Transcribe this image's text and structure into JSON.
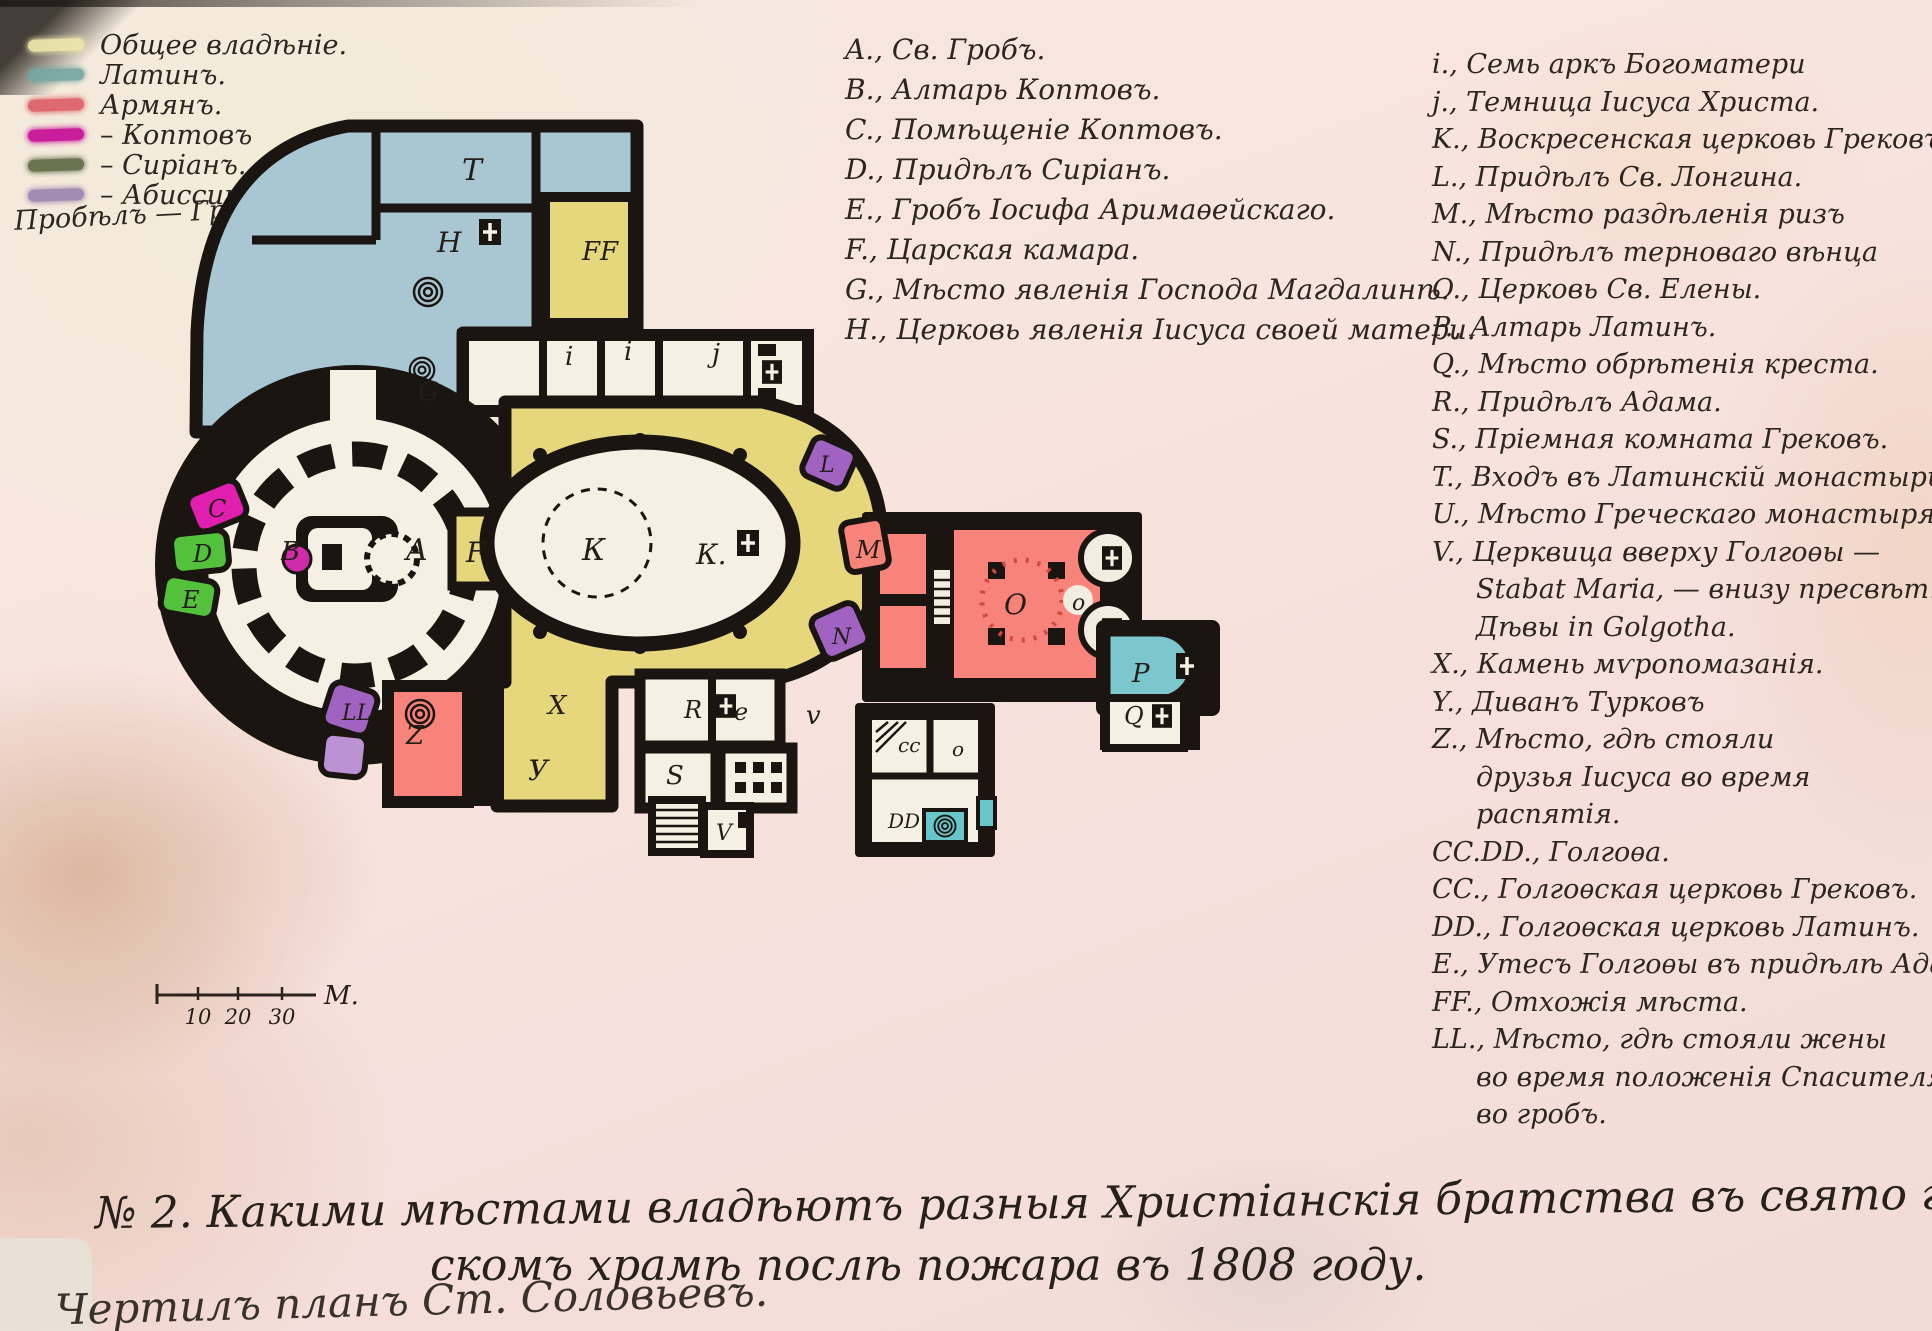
{
  "legend": {
    "items": [
      {
        "label": "Общее владѣніе.",
        "color": "#efe9ac"
      },
      {
        "label": "Латинъ.",
        "color": "#76a8a2"
      },
      {
        "label": "Армянъ.",
        "color": "#dd5f68"
      },
      {
        "label": "– Коптовъ",
        "color": "#c60d97"
      },
      {
        "label": "– Сиріанъ.",
        "color": "#5f6b44"
      },
      {
        "label": "– Абиссинцевъ",
        "color": "#9c85b0"
      }
    ],
    "footnote": "Пробѣлъ — Грековъ."
  },
  "center_list": {
    "items": [
      "A., Св. Гробъ.",
      "B., Алтарь Коптовъ.",
      "C., Помѣщеніе Коптовъ.",
      "D., Придѣлъ Сиріанъ.",
      "E., Гробъ Іосифа Аримаѳейскаго.",
      "F., Царская камара.",
      "G., Мѣсто явленія Господа Магдалинѣ.",
      "H., Церковь явленія Іисуса своей матери."
    ]
  },
  "right_list": {
    "items": [
      {
        "lines": [
          "i., Семь аркъ Богоматери"
        ]
      },
      {
        "lines": [
          "j., Темница Іисуса Христа."
        ]
      },
      {
        "lines": [
          "K., Воскресенская церковь Грековъ."
        ]
      },
      {
        "lines": [
          "L., Придѣлъ Св. Лонгина."
        ]
      },
      {
        "lines": [
          "M., Мѣсто раздѣленія ризъ"
        ]
      },
      {
        "lines": [
          "N., Придѣлъ терноваго вѣнца"
        ]
      },
      {
        "lines": [
          "O., Церковь Св. Елены."
        ]
      },
      {
        "lines": [
          "P., Алтарь Латинъ."
        ]
      },
      {
        "lines": [
          "Q., Мѣсто обрѣтенія креста."
        ]
      },
      {
        "lines": [
          "R., Придѣлъ Адама."
        ]
      },
      {
        "lines": [
          "S., Пріемная комната Грековъ."
        ]
      },
      {
        "lines": [
          "T., Входъ въ Латинскій монастырь"
        ]
      },
      {
        "lines": [
          "U., Мѣсто Греческаго монастыря"
        ]
      },
      {
        "lines": [
          "V., Церквица вверху Голгоѳы —",
          "Stabat Maria, — внизу пресвѣт.",
          "Дѣвы in Golgotha."
        ]
      },
      {
        "lines": [
          "X., Камень мѵропомазанія."
        ]
      },
      {
        "lines": [
          "Y., Диванъ Турковъ"
        ]
      },
      {
        "lines": [
          "Z., Мѣсто, гдѣ стояли",
          "друзья Іисуса во время",
          "распятія."
        ]
      },
      {
        "lines": [
          "CC.DD., Голгоѳа."
        ]
      },
      {
        "lines": [
          "CC., Голгоѳская церковь Грековъ."
        ]
      },
      {
        "lines": [
          "DD., Голгоѳская церковь Латинъ."
        ]
      },
      {
        "lines": [
          "E., Утесъ Голгоѳы въ придѣлѣ Адама."
        ]
      },
      {
        "lines": [
          "FF., Отхожія мѣста."
        ]
      },
      {
        "lines": [
          "LL., Мѣсто, гдѣ стояли жены",
          "во время положенія Спасителя",
          "во гробъ."
        ]
      }
    ]
  },
  "plan": {
    "labels": [
      {
        "t": "T",
        "x": 462,
        "y": 180,
        "s": 30
      },
      {
        "t": "H",
        "x": 437,
        "y": 252,
        "s": 28
      },
      {
        "t": "FF",
        "x": 582,
        "y": 260,
        "s": 26
      },
      {
        "t": "G",
        "x": 418,
        "y": 400,
        "s": 26
      },
      {
        "t": "i",
        "x": 565,
        "y": 365,
        "s": 26
      },
      {
        "t": "i",
        "x": 624,
        "y": 360,
        "s": 26
      },
      {
        "t": "j",
        "x": 712,
        "y": 362,
        "s": 26
      },
      {
        "t": "B",
        "x": 281,
        "y": 560,
        "s": 26
      },
      {
        "t": "A",
        "x": 406,
        "y": 560,
        "s": 30
      },
      {
        "t": "F",
        "x": 466,
        "y": 562,
        "s": 28
      },
      {
        "t": "К",
        "x": 582,
        "y": 560,
        "s": 30
      },
      {
        "t": "К.",
        "x": 696,
        "y": 564,
        "s": 28
      },
      {
        "t": "C",
        "x": 208,
        "y": 517,
        "s": 24
      },
      {
        "t": "D",
        "x": 193,
        "y": 562,
        "s": 24
      },
      {
        "t": "E",
        "x": 182,
        "y": 608,
        "s": 24
      },
      {
        "t": "LL",
        "x": 342,
        "y": 720,
        "s": 22
      },
      {
        "t": "L",
        "x": 820,
        "y": 472,
        "s": 22
      },
      {
        "t": "М",
        "x": 856,
        "y": 558,
        "s": 24
      },
      {
        "t": "N",
        "x": 832,
        "y": 644,
        "s": 22
      },
      {
        "t": "X",
        "x": 548,
        "y": 714,
        "s": 26
      },
      {
        "t": "У",
        "x": 528,
        "y": 780,
        "s": 28
      },
      {
        "t": "Z",
        "x": 406,
        "y": 744,
        "s": 26
      },
      {
        "t": "R",
        "x": 684,
        "y": 718,
        "s": 24
      },
      {
        "t": "e",
        "x": 734,
        "y": 720,
        "s": 24
      },
      {
        "t": "S",
        "x": 666,
        "y": 784,
        "s": 26
      },
      {
        "t": "V",
        "x": 716,
        "y": 840,
        "s": 22
      },
      {
        "t": "v",
        "x": 806,
        "y": 724,
        "s": 26
      },
      {
        "t": "О",
        "x": 1004,
        "y": 614,
        "s": 28
      },
      {
        "t": "o",
        "x": 1072,
        "y": 610,
        "s": 22
      },
      {
        "t": "P",
        "x": 1132,
        "y": 682,
        "s": 26
      },
      {
        "t": "Q",
        "x": 1124,
        "y": 724,
        "s": 24
      },
      {
        "t": "cc",
        "x": 898,
        "y": 752,
        "s": 20
      },
      {
        "t": "o",
        "x": 952,
        "y": 756,
        "s": 20
      },
      {
        "t": "DD",
        "x": 888,
        "y": 828,
        "s": 20
      }
    ]
  },
  "scale_bar": {
    "ticks": [
      {
        "label": "10",
        "x": 198
      },
      {
        "label": "20",
        "x": 238
      },
      {
        "label": "30",
        "x": 282
      }
    ],
    "unit": "М.",
    "unit_x": 324
  },
  "caption": {
    "line1": "№ 2. Какими мѣстами владѣютъ разныя Христіанскія братства въ свято гроб-",
    "line2": "скомъ храмѣ послѣ пожара въ 1808 году."
  },
  "signature": "Чертилъ планъ Ст. Соловьевъ.",
  "icons": {
    "altar_cross_icon": "⊞",
    "spiral_stair_icon": "◎"
  },
  "colors": {
    "common_yellow": "#e7d77c",
    "latin_blue": "#a9c6d3",
    "armenian_red": "#f8837a",
    "coptic_magenta": "#e01fae",
    "syrian_green": "#53c13c",
    "abyssinian_purple": "#a163c2",
    "teal_rooms": "#68c6cb",
    "ink": "#1a1511"
  }
}
